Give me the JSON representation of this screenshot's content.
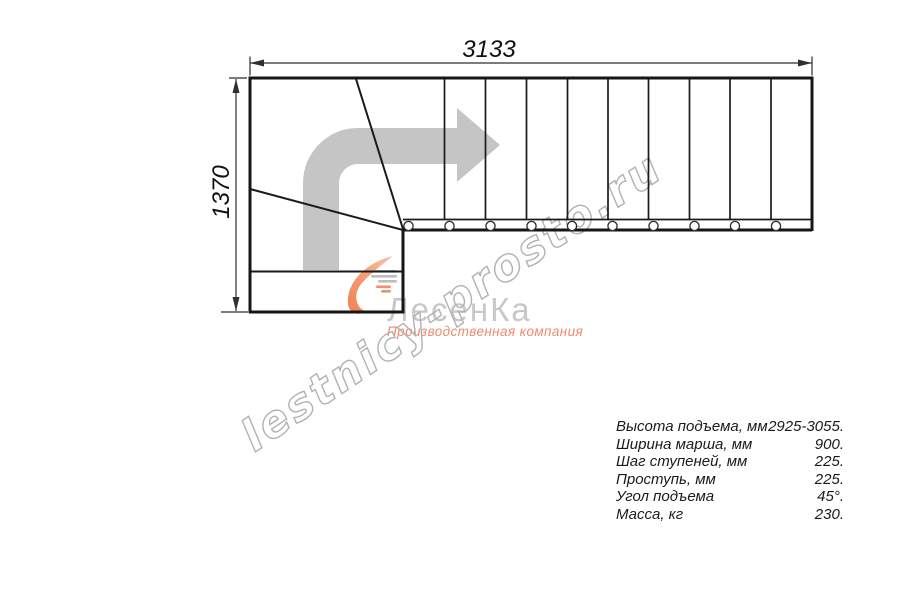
{
  "drawing": {
    "dimension_width_mm": "3133",
    "dimension_height_mm": "1370"
  },
  "watermark": {
    "text": "lestnicy-prosto.ru"
  },
  "logo": {
    "brand": "ЛесенКа",
    "subtitle": "Производственная компания"
  },
  "specs": {
    "rows": [
      {
        "label": "Высота подъема, мм",
        "value": "2925-3055."
      },
      {
        "label": "Ширина марша, мм",
        "value": "900."
      },
      {
        "label": "Шаг ступеней, мм",
        "value": "225."
      },
      {
        "label": "Проступь, мм",
        "value": "225."
      },
      {
        "label": "Угол подъема",
        "value": "45°."
      },
      {
        "label": "Масса, кг",
        "value": "230."
      }
    ]
  },
  "colors": {
    "line": "#1a1a1a",
    "dimension": "#2f2f2f",
    "arrow_fill": "#c5c5c5",
    "watermark_outline": "#b2b2b2",
    "logo_brand_gray": "#c8c8c8",
    "logo_accent_salmon": "#ee8a6d"
  }
}
